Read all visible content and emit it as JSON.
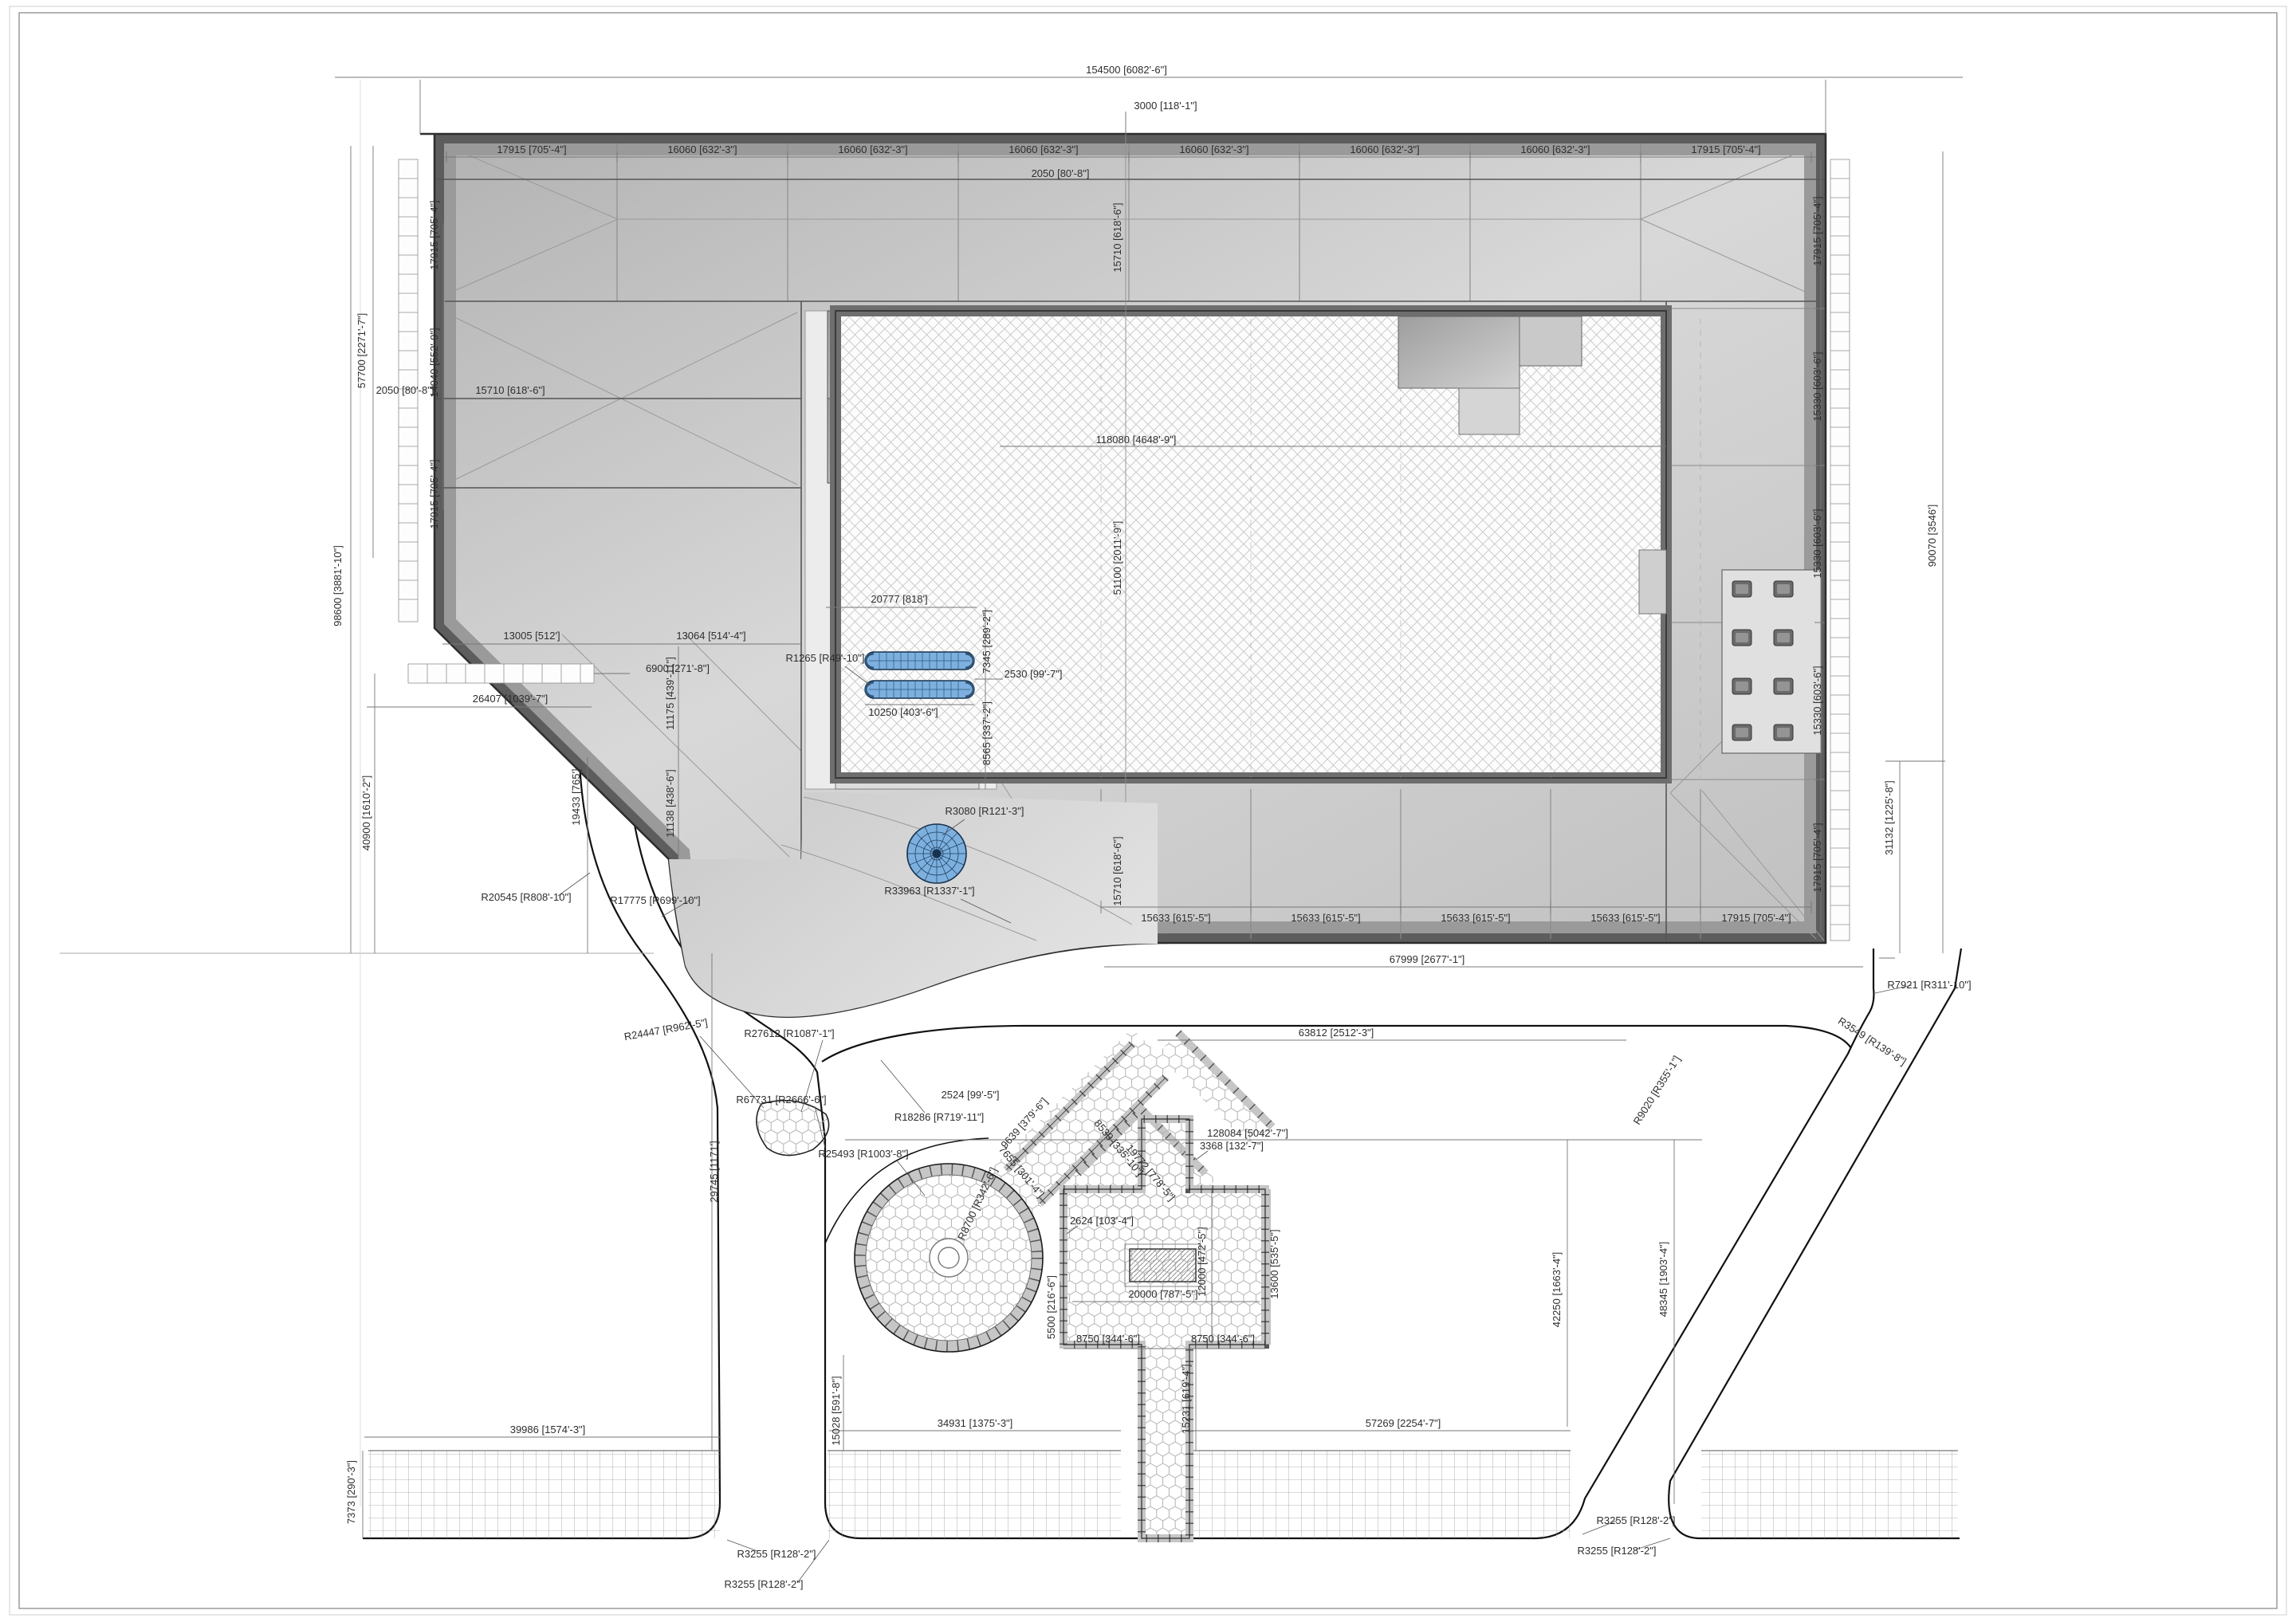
{
  "document": {
    "kind_note": ""
  },
  "colors": {
    "parapet_dark": "#5d5d5d",
    "band_mid": "#9a9a9a",
    "roof_light": "#d9d9d9",
    "pool_blue": "#7db0de",
    "pool_line": "#16324f",
    "line_black": "#111111",
    "dim_gray": "#666666"
  },
  "labels": {
    "overall": "154500 [6082'-6\"]",
    "offset3000": "3000 [118'-1\"]",
    "parapet2050": "2050 [80'-8\"]",
    "bay17915": "17915 [705'-4\"]",
    "bay16060": "16060 [632'-3\"]",
    "left57700": "57700 [2271'-7\"]",
    "left98600": "98600 [3881'-10\"]",
    "left40900": "40900 [1610'-2\"]",
    "d14040": "14040 [552'-9\"]",
    "d15710": "15710 [618'-6\"]",
    "d13005": "13005 [512']",
    "d13064": "13064 [514'-4\"]",
    "d6900": "6900 [271'-8\"]",
    "d26407": "26407 [1039'-7\"]",
    "d11175": "11175 [439'-11\"]",
    "d11138": "11138 [438'-6\"]",
    "d19433": "19433 [765']",
    "d15330": "15330 [603'-6\"]",
    "d118080": "118080 [4648'-9\"]",
    "d51100": "51100 [2011'-9\"]",
    "d20777": "20777 [818']",
    "d10250": "10250 [403'-6\"]",
    "d2530": "2530 [99'-7\"]",
    "d7345": "7345 [289'-2\"]",
    "d8565": "8565 [337'-2\"]",
    "r1265": "R1265 [R49'-10\"]",
    "r3080": "R3080 [R121'-3\"]",
    "r33963": "R33963 [R1337'-1\"]",
    "d15633": "15633 [615'-5\"]",
    "d67999": "67999 [2677'-1\"]",
    "r20545": "R20545 [R808'-10\"]",
    "r17775": "R17775 [R699'-10\"]",
    "r18286": "R18286 [R719'-11\"]",
    "r25493": "R25493 [R1003'-8\"]",
    "r24447": "R24447 [R962'-5\"]",
    "r27612": "R27612 [R1087'-1\"]",
    "r67731": "R67731 [R2666'-6\"]",
    "d2524": "2524 [99'-5\"]",
    "d9639": "9639 [379'-6\"]",
    "d7655": "7655 [301'-4\"]",
    "d8530": "8530 [335'-10\"]",
    "d19772": "19772 [778'-5\"]",
    "d63812": "63812 [2512'-3\"]",
    "d128084": "128084 [5042'-7\"]",
    "r9020": "R9020 [R355'-1\"]",
    "d31132": "31132 [1225'-8\"]",
    "d90070": "90070 [3546']",
    "r7921": "R7921 [R311'-10\"]",
    "r3549": "R3549 [R139'-8\"]",
    "d42250": "42250 [1663'-4\"]",
    "d48345": "48345 [1903'-4\"]",
    "r8700": "R8700 [R342'-6\"]",
    "d3368": "3368 [132'-7\"]",
    "d2624": "2624 [103'-4\"]",
    "d5500": "5500 [216'-6\"]",
    "d20000": "20000 [787'-5\"]",
    "d12000": "12000 [472'-5\"]",
    "d13600": "13600 [535'-5\"]",
    "d8750": "8750 [344'-6\"]",
    "d15231": "15231 [619'-4\"]",
    "d39986": "39986 [1574'-3\"]",
    "d7373": "7373 [290'-3\"]",
    "d34931": "34931 [1375'-3\"]",
    "d15028": "15028 [591'-8\"]",
    "d29745": "29745 [1171']",
    "d57269": "57269 [2254'-7\"]",
    "r3255": "R3255 [R128'-2\"]"
  }
}
